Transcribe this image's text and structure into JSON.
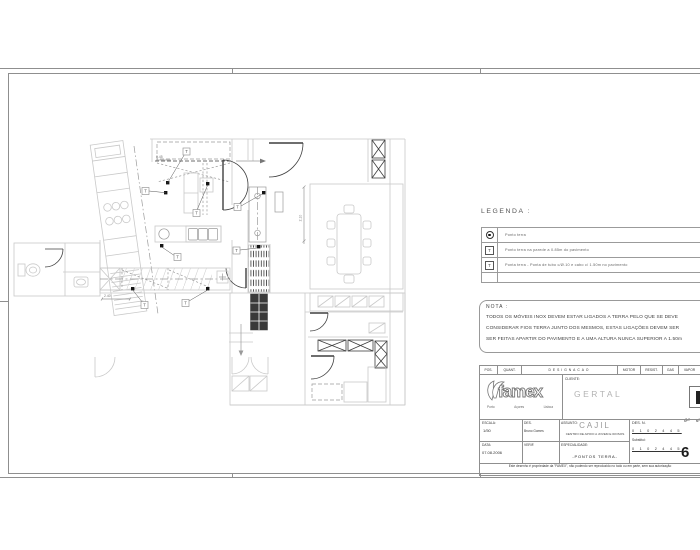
{
  "colors": {
    "frame_line": "#8f8f8f",
    "plan_light": "#c9c9c9",
    "plan_mid": "#9a9a9a",
    "plan_dark": "#3f3f3f",
    "ground_point": "#151515",
    "faint_text": "#b3b3b3",
    "table_line": "#999999"
  },
  "legend": {
    "title": "LEGENDA :",
    "rows": [
      {
        "symbol": "ground-dot",
        "text": "Ponto terra"
      },
      {
        "symbol": "T",
        "text": "Ponto terra na parede a 0.85m do pavimento"
      },
      {
        "symbol": "T",
        "text": "Ponta terra -  Ponta de tubo c/Ø.10 e cabo c/ 1.50m no pavimento"
      }
    ]
  },
  "note": {
    "title": "NOTA  :",
    "line1": "TODOS OS MÓVEIS INOX DEVEM ESTAR LIGADOS A TERRA PELO QUE SE DEVE",
    "line2": "CONSIDERAR FIOS TERRA JUNTO DOS MESMOS, ESTAS LIGAÇÕES DEVEM SER",
    "line3": "SER FEITAS APARTIR DO PAVIMENTO E A UMA ALTURA NUNCA SUPERIOR A 1.50m"
  },
  "titleblock": {
    "header": [
      "POS.",
      "QUANT.",
      "DESIGNACAO",
      "MOTOR",
      "RESIST.",
      "GAS",
      "VAPOR",
      "AG. F.",
      "AG. Q."
    ],
    "logo_text": "famex",
    "logo_cities": [
      "Porto",
      "Açores",
      "Lisboa"
    ],
    "cliente_label": "CLIENTE:",
    "cliente_value": "GERTAL",
    "escala_label": "ESCALA:",
    "escala_value": "1/50",
    "des_label": "DES.",
    "des_value": "Bruno Gomes",
    "data_label": "DATA:",
    "data_value": "07.08.2006",
    "verif_label": "VERIF.",
    "assunto_label": "ASSUNTO:",
    "assunto_value": "CAJIL",
    "assunto_sub": "CENTRO DE APOIO A JOVEM E IDOSOS",
    "especialidade_label": "ESPECIALIDADE:",
    "especialidade_value": "-PONTOS TERRA-",
    "desn_label": "DES. N.",
    "desn_note": "ge",
    "desn_super": "6ª",
    "rev_row1": "0 1 0 2 4 4 5",
    "substitui_label": "Substitui:",
    "rev_row2": "0 1 0 2 4 4 5",
    "sheet_number": "6",
    "copyright": "Este desenho é propriedade da \"FAMEX\", não podendo ser reproduzido no todo ou em parte, sem sua autorização"
  },
  "plan": {
    "ground_label": "T",
    "dim_counter": "2.40",
    "dim_height": "2.10",
    "dim_top": "0.45"
  }
}
